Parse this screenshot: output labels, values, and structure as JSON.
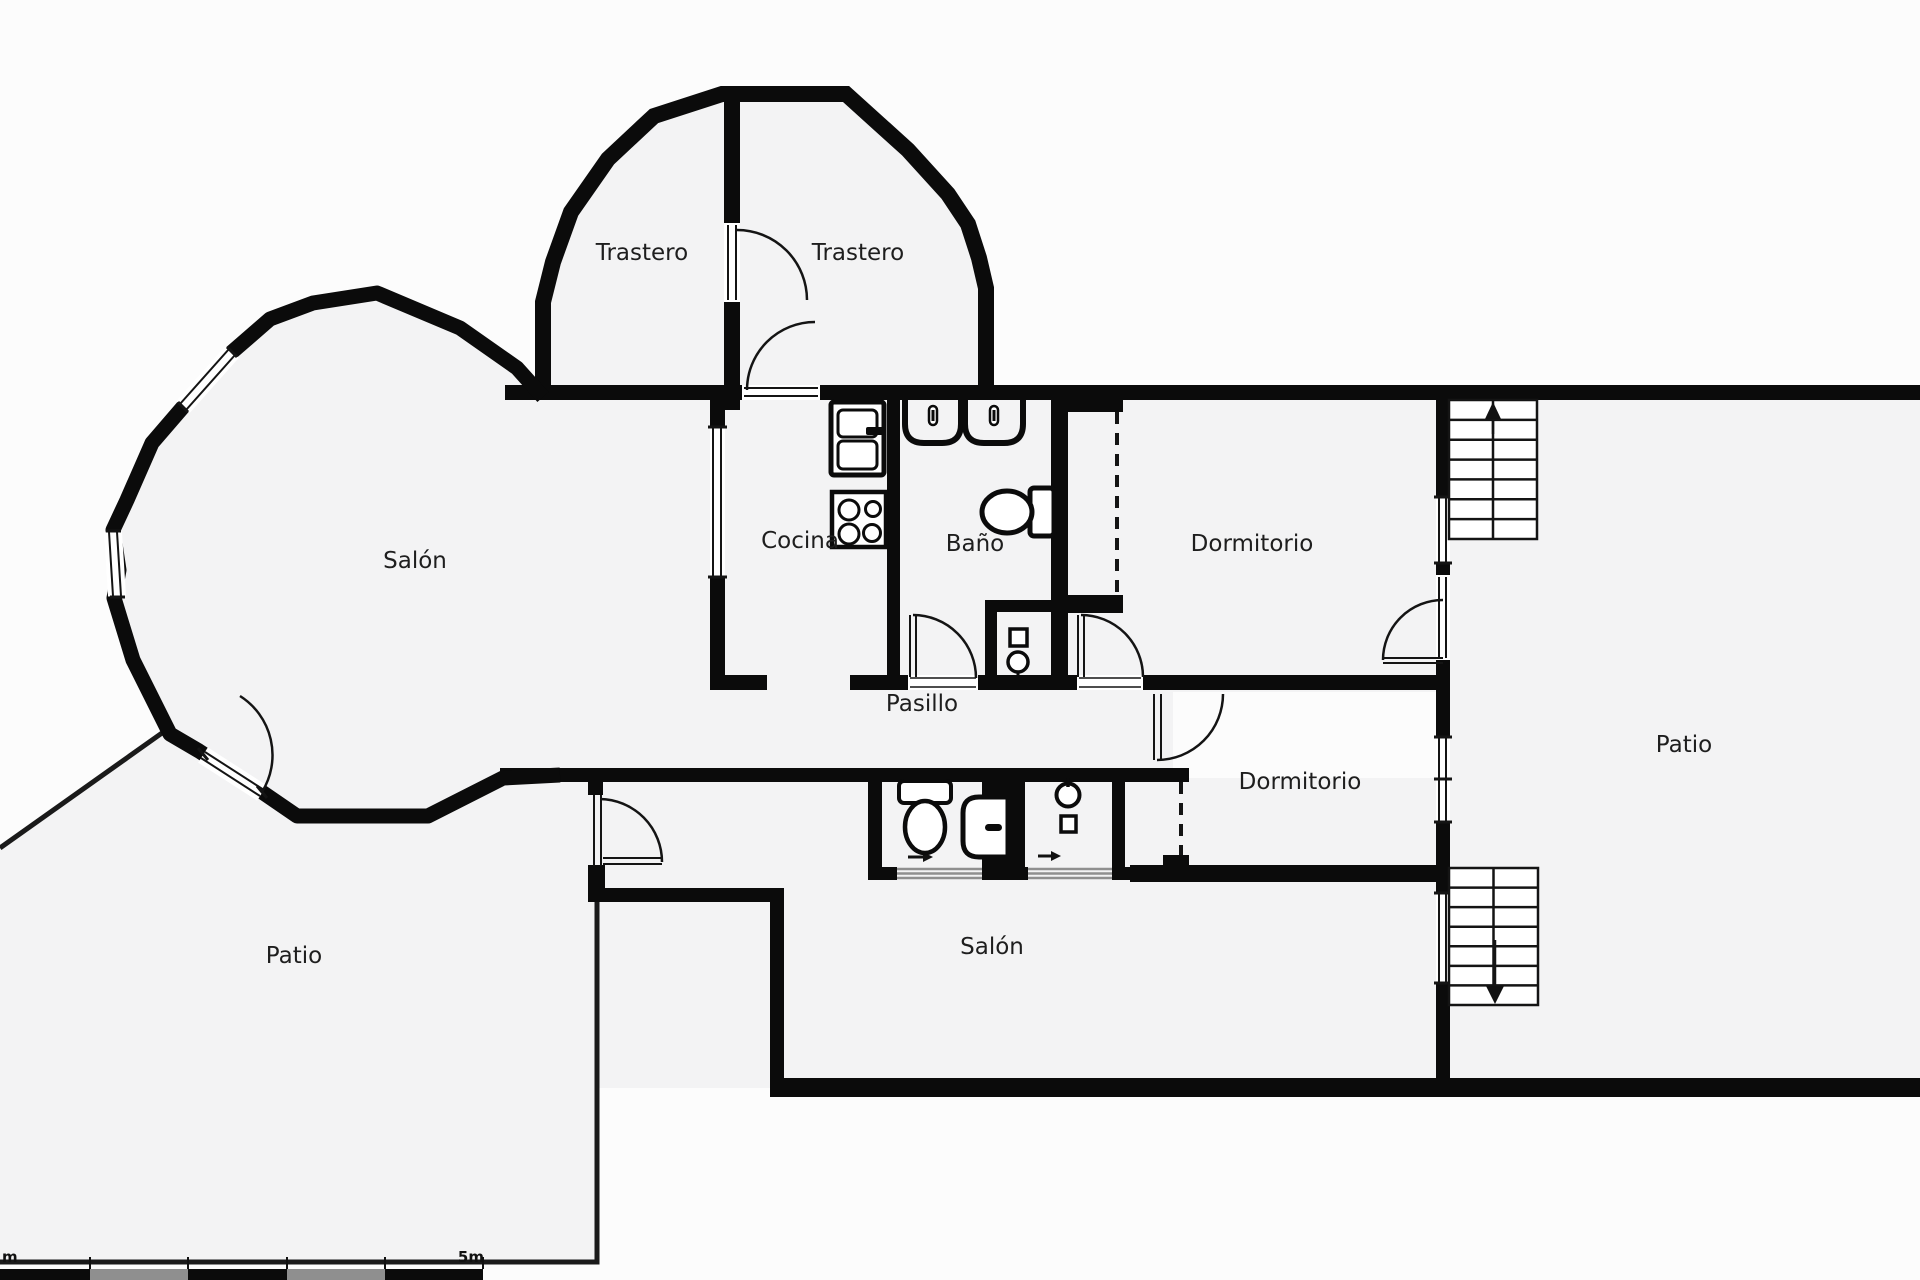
{
  "plan": {
    "type": "floor-plan",
    "language": "es",
    "rooms": [
      {
        "id": "trastero-left",
        "label": "Trastero"
      },
      {
        "id": "trastero-right",
        "label": "Trastero"
      },
      {
        "id": "salon-main",
        "label": "Salón"
      },
      {
        "id": "cocina",
        "label": "Cocina"
      },
      {
        "id": "bano",
        "label": "Baño"
      },
      {
        "id": "dormitorio-top",
        "label": "Dormitorio"
      },
      {
        "id": "pasillo",
        "label": "Pasillo"
      },
      {
        "id": "dormitorio-lower",
        "label": "Dormitorio"
      },
      {
        "id": "patio-left",
        "label": "Patio"
      },
      {
        "id": "salon-lower",
        "label": "Salón"
      },
      {
        "id": "patio-right",
        "label": "Patio"
      }
    ],
    "stairs": [
      {
        "id": "stairs-upper",
        "direction": "up",
        "steps": 7
      },
      {
        "id": "stairs-lower",
        "direction": "down",
        "steps": 7
      }
    ],
    "fixtures": [
      "fridge",
      "stove",
      "double-sink",
      "toilet",
      "toilet-2",
      "shower",
      "round-washbasin",
      "washer",
      "utility-sink"
    ],
    "scale_bar": {
      "left_label": "m",
      "right_label": "5m",
      "segments": 5,
      "meters": 5
    },
    "colors": {
      "wall": "#0b0b0b",
      "floor": "#f3f3f4",
      "background": "#fcfcfc",
      "thin_line": "#141414",
      "slider_gray": "#8f8f8f",
      "label": "#1e1e1e"
    }
  }
}
